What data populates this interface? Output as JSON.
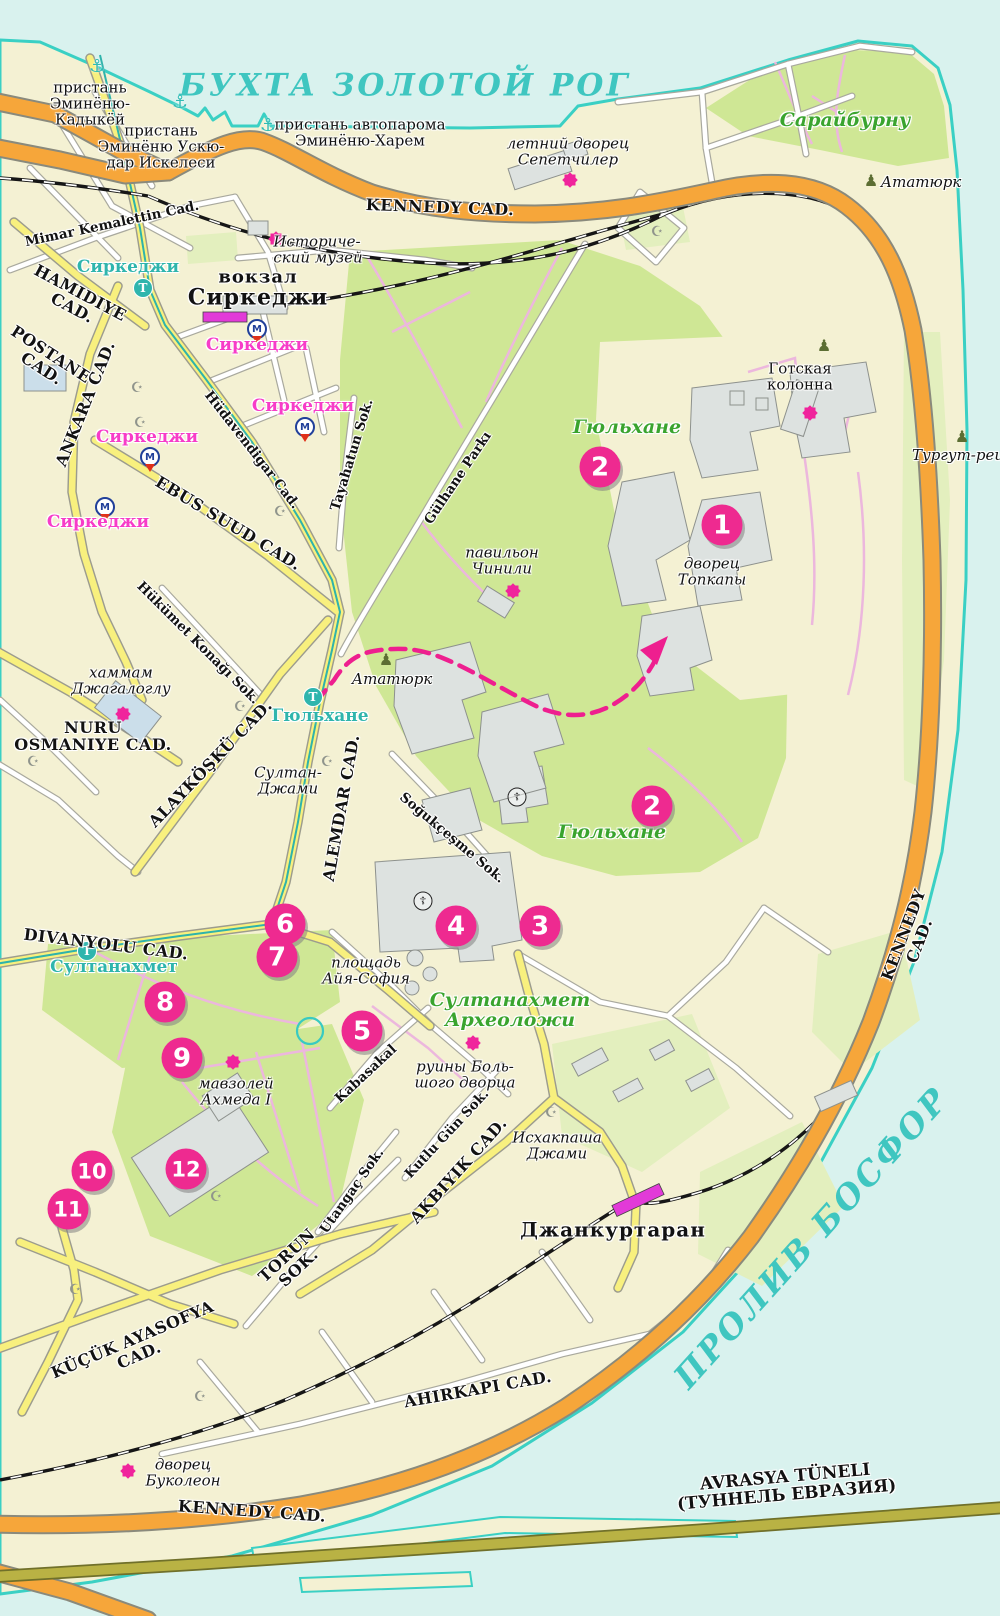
{
  "colors": {
    "water": "#d9f2ee",
    "land": "#f4f1d3",
    "coast": "#3ad0c4",
    "park": "#cfe795",
    "park_pale": "#e3efbe",
    "park_path": "#ecb7dd",
    "road_major": "#f6a63a",
    "road_secondary": "#f8f07e",
    "tunnel_road": "#b9b244",
    "route": "#ee1f8f",
    "marker": "#ee2a90",
    "star": "#f0249c",
    "station_rect": "#e23ad8",
    "sea_label": "#3fc6c0",
    "green_label": "#3aa42e",
    "tram_label": "#2fb5ad",
    "metro_label": "#f73cc8"
  },
  "glyphs": {
    "anchor": "⚓",
    "mosque": "☪",
    "church": "☦",
    "monument": "♟",
    "tram": "T",
    "metro": "M"
  },
  "labels": [
    {
      "name": "label-bay-golden-horn",
      "lines": [
        "БУХТА ЗОЛОТОЙ РОГ"
      ],
      "x": 405,
      "y": 86,
      "rot": 0,
      "cls": "sea sea-top"
    },
    {
      "name": "label-bosphorus",
      "lines": [
        "ПРОЛИВ БОСФОР"
      ],
      "x": 812,
      "y": 1238,
      "rot": -48,
      "cls": "sea sea-right"
    },
    {
      "name": "label-pier-eminonu-kadikoy",
      "lines": [
        "пристань",
        "Эминёню-",
        "Кадыкёй"
      ],
      "x": 90,
      "y": 104,
      "rot": 0,
      "cls": "place"
    },
    {
      "name": "label-pier-eminonu-uskudar",
      "lines": [
        "пристань",
        "Эминёню Ускю-",
        "дар Искелеси"
      ],
      "x": 161,
      "y": 147,
      "rot": 0,
      "cls": "place"
    },
    {
      "name": "label-pier-car-ferry",
      "lines": [
        "пристань автопарома",
        "Эминёню-Харем"
      ],
      "x": 360,
      "y": 133,
      "rot": 0,
      "cls": "place"
    },
    {
      "name": "label-summer-palace",
      "lines": [
        "летний дворец",
        "Сепетчилер"
      ],
      "x": 568,
      "y": 152,
      "rot": 0,
      "cls": "place-it"
    },
    {
      "name": "label-sarayburnu",
      "lines": [
        "Сарайбурну"
      ],
      "x": 845,
      "y": 121,
      "rot": 0,
      "cls": "green"
    },
    {
      "name": "label-ataturk-ne",
      "lines": [
        "Ататюрк"
      ],
      "x": 921,
      "y": 183,
      "rot": 0,
      "cls": "place-it"
    },
    {
      "name": "label-kennedy-top",
      "lines": [
        "KENNEDY CAD."
      ],
      "x": 440,
      "y": 208,
      "rot": 2,
      "cls": "road-lg"
    },
    {
      "name": "label-mimar-kemalettin",
      "lines": [
        "Mimar Kemalettin Cad."
      ],
      "x": 112,
      "y": 224,
      "rot": -12,
      "cls": "road"
    },
    {
      "name": "label-sirkeci-tram",
      "lines": [
        "Сиркеджи"
      ],
      "x": 128,
      "y": 268,
      "rot": 0,
      "cls": "tram-stop"
    },
    {
      "name": "label-station-vokzal",
      "lines": [
        "вокзал"
      ],
      "x": 258,
      "y": 278,
      "rot": 0,
      "cls": "place-lg"
    },
    {
      "name": "label-station-sirkeci",
      "lines": [
        "Сиркеджи"
      ],
      "x": 258,
      "y": 298,
      "rot": 0,
      "cls": "place-xl"
    },
    {
      "name": "label-history-museum",
      "lines": [
        "Историче-",
        "ский музей"
      ],
      "x": 318,
      "y": 250,
      "rot": 0,
      "cls": "place-it left"
    },
    {
      "name": "label-sirkeci-m1",
      "lines": [
        "Сиркеджи"
      ],
      "x": 257,
      "y": 346,
      "rot": 0,
      "cls": "metro-stop"
    },
    {
      "name": "label-hamidiye",
      "lines": [
        "HAMIDIYE",
        "CAD."
      ],
      "x": 76,
      "y": 301,
      "rot": 28,
      "cls": "road-lg"
    },
    {
      "name": "label-postane",
      "lines": [
        "POSTANE",
        "CAD."
      ],
      "x": 46,
      "y": 362,
      "rot": 33,
      "cls": "road-lg"
    },
    {
      "name": "label-ankara",
      "lines": [
        "ANKARA CAD."
      ],
      "x": 86,
      "y": 404,
      "rot": -68,
      "cls": "road-lg"
    },
    {
      "name": "label-sirkeci-m2",
      "lines": [
        "Сиркеджи"
      ],
      "x": 303,
      "y": 407,
      "rot": 0,
      "cls": "metro-stop"
    },
    {
      "name": "label-sirkeci-m3",
      "lines": [
        "Сиркеджи"
      ],
      "x": 147,
      "y": 438,
      "rot": 0,
      "cls": "metro-stop"
    },
    {
      "name": "label-sirkeci-m4",
      "lines": [
        "Сиркеджи"
      ],
      "x": 98,
      "y": 523,
      "rot": 0,
      "cls": "metro-stop"
    },
    {
      "name": "label-hudavendigar",
      "lines": [
        "Hüdavendigar Cad."
      ],
      "x": 252,
      "y": 450,
      "rot": 52,
      "cls": "road"
    },
    {
      "name": "label-tayahatun",
      "lines": [
        "Tayahatun Sok."
      ],
      "x": 352,
      "y": 455,
      "rot": -73,
      "cls": "road"
    },
    {
      "name": "label-ebussuud",
      "lines": [
        "EBUS SUUD CAD."
      ],
      "x": 228,
      "y": 524,
      "rot": 31,
      "cls": "road-lg"
    },
    {
      "name": "label-gulhane-parki",
      "lines": [
        "Gülhane Parkı"
      ],
      "x": 458,
      "y": 478,
      "rot": -56,
      "cls": "road"
    },
    {
      "name": "label-gulhane-green-1",
      "lines": [
        "Гюльхане"
      ],
      "x": 627,
      "y": 428,
      "rot": 0,
      "cls": "green"
    },
    {
      "name": "label-gulhane-green-2",
      "lines": [
        "Гюльхане"
      ],
      "x": 612,
      "y": 833,
      "rot": 0,
      "cls": "green"
    },
    {
      "name": "label-gothic-column",
      "lines": [
        "Готская",
        "колонна"
      ],
      "x": 800,
      "y": 377,
      "rot": 0,
      "cls": "place"
    },
    {
      "name": "label-turgut",
      "lines": [
        "Тургут-реи"
      ],
      "x": 958,
      "y": 456,
      "rot": 0,
      "cls": "place-it"
    },
    {
      "name": "label-cinili",
      "lines": [
        "павильон",
        "Чинили"
      ],
      "x": 502,
      "y": 561,
      "rot": 0,
      "cls": "place-it"
    },
    {
      "name": "label-topkapi",
      "lines": [
        "дворец",
        "Топкапы"
      ],
      "x": 712,
      "y": 572,
      "rot": 0,
      "cls": "place-it"
    },
    {
      "name": "label-hamam",
      "lines": [
        "хаммам",
        "Джагалоглу"
      ],
      "x": 121,
      "y": 681,
      "rot": 0,
      "cls": "place-it"
    },
    {
      "name": "label-nuruosmaniye",
      "lines": [
        "NURU",
        "OSMANIYE CAD."
      ],
      "x": 93,
      "y": 737,
      "rot": 0,
      "cls": "road-lg"
    },
    {
      "name": "label-hukumet-konagi",
      "lines": [
        "Hükümet Konağı Sok."
      ],
      "x": 198,
      "y": 643,
      "rot": 45,
      "cls": "road"
    },
    {
      "name": "label-gulhane-tram",
      "lines": [
        "Гюльхане"
      ],
      "x": 320,
      "y": 717,
      "rot": 0,
      "cls": "tram-stop"
    },
    {
      "name": "label-ataturk-center",
      "lines": [
        "Ататюрк"
      ],
      "x": 392,
      "y": 680,
      "rot": 0,
      "cls": "place-it"
    },
    {
      "name": "label-sultan-cami",
      "lines": [
        "Султан-",
        "Джами"
      ],
      "x": 288,
      "y": 781,
      "rot": 0,
      "cls": "place-it"
    },
    {
      "name": "label-alemdar",
      "lines": [
        "ALEMDAR CAD."
      ],
      "x": 342,
      "y": 808,
      "rot": -80,
      "cls": "road-lg"
    },
    {
      "name": "label-alaykosku",
      "lines": [
        "ALAYKÖŞKÜ CAD."
      ],
      "x": 211,
      "y": 764,
      "rot": -46,
      "cls": "road-lg"
    },
    {
      "name": "label-sogukcesme",
      "lines": [
        "Soğukçeşme Sok."
      ],
      "x": 452,
      "y": 838,
      "rot": 40,
      "cls": "road"
    },
    {
      "name": "label-divanyolu",
      "lines": [
        "DIVANYOLU CAD."
      ],
      "x": 106,
      "y": 945,
      "rot": 7,
      "cls": "road-lg"
    },
    {
      "name": "label-sultanahmet-tram",
      "lines": [
        "Султанахмет"
      ],
      "x": 114,
      "y": 968,
      "rot": 0,
      "cls": "tram-stop"
    },
    {
      "name": "label-ayasofya-square",
      "lines": [
        "площадь",
        "Айя-София"
      ],
      "x": 366,
      "y": 971,
      "rot": 0,
      "cls": "place-it"
    },
    {
      "name": "label-sultanahmet-arch",
      "lines": [
        "Султанахмет",
        "Археоложи"
      ],
      "x": 510,
      "y": 1011,
      "rot": 0,
      "cls": "green"
    },
    {
      "name": "label-palace-ruins",
      "lines": [
        "руины Боль-",
        "шого дворца"
      ],
      "x": 465,
      "y": 1075,
      "rot": 0,
      "cls": "place-it"
    },
    {
      "name": "label-mausoleum",
      "lines": [
        "мавзолей",
        "Ахмеда I"
      ],
      "x": 236,
      "y": 1092,
      "rot": 0,
      "cls": "place-it"
    },
    {
      "name": "label-kabasakal",
      "lines": [
        "Kabasakal"
      ],
      "x": 366,
      "y": 1074,
      "rot": -43,
      "cls": "road"
    },
    {
      "name": "label-kutlu-gun",
      "lines": [
        "Kutlu Gün Sok."
      ],
      "x": 447,
      "y": 1134,
      "rot": -47,
      "cls": "road"
    },
    {
      "name": "label-utangac",
      "lines": [
        "Utangaç Sok."
      ],
      "x": 352,
      "y": 1191,
      "rot": -55,
      "cls": "road"
    },
    {
      "name": "label-akbiyik",
      "lines": [
        "AKBIYIK CAD."
      ],
      "x": 459,
      "y": 1171,
      "rot": -48,
      "cls": "road-lg"
    },
    {
      "name": "label-ishakpasha",
      "lines": [
        "Исхакпаша",
        "Джами"
      ],
      "x": 557,
      "y": 1146,
      "rot": 0,
      "cls": "place-it"
    },
    {
      "name": "label-cankurtaran",
      "lines": [
        "Джанкуртаран"
      ],
      "x": 613,
      "y": 1230,
      "rot": 0,
      "cls": "station-name"
    },
    {
      "name": "label-torun",
      "lines": [
        "TORUN",
        "SOK."
      ],
      "x": 293,
      "y": 1262,
      "rot": -43,
      "cls": "road-lg"
    },
    {
      "name": "label-kucuk-ayasofya",
      "lines": [
        "KÜÇÜK AYASOFYA",
        "CAD."
      ],
      "x": 136,
      "y": 1348,
      "rot": -23,
      "cls": "road-lg"
    },
    {
      "name": "label-ahirkapi",
      "lines": [
        "AHIRKAPI CAD."
      ],
      "x": 478,
      "y": 1390,
      "rot": -10,
      "cls": "road-lg"
    },
    {
      "name": "label-bucoleon",
      "lines": [
        "дворец",
        "Буколеон"
      ],
      "x": 183,
      "y": 1473,
      "rot": 0,
      "cls": "place-it"
    },
    {
      "name": "label-kennedy-bottom",
      "lines": [
        "KENNEDY CAD."
      ],
      "x": 252,
      "y": 1512,
      "rot": 4,
      "cls": "road-lg"
    },
    {
      "name": "label-avrasya",
      "lines": [
        "AVRASYA TÜNELI",
        "(ТУННЕЛЬ ЕВРАЗИЯ)"
      ],
      "x": 786,
      "y": 1487,
      "rot": -5,
      "cls": "tunnel"
    },
    {
      "name": "label-kennedy-right",
      "lines": [
        "KENNEDY",
        "CAD."
      ],
      "x": 912,
      "y": 938,
      "rot": -69,
      "cls": "road-lg"
    }
  ],
  "markers": [
    {
      "n": "1",
      "x": 722,
      "y": 525
    },
    {
      "n": "2",
      "x": 600,
      "y": 467
    },
    {
      "n": "2",
      "x": 652,
      "y": 806
    },
    {
      "n": "3",
      "x": 540,
      "y": 926
    },
    {
      "n": "4",
      "x": 456,
      "y": 926
    },
    {
      "n": "5",
      "x": 362,
      "y": 1031
    },
    {
      "n": "6",
      "x": 285,
      "y": 924
    },
    {
      "n": "7",
      "x": 277,
      "y": 957
    },
    {
      "n": "8",
      "x": 165,
      "y": 1002
    },
    {
      "n": "9",
      "x": 182,
      "y": 1058
    },
    {
      "n": "10",
      "x": 92,
      "y": 1171
    },
    {
      "n": "11",
      "x": 68,
      "y": 1209
    },
    {
      "n": "12",
      "x": 186,
      "y": 1169
    }
  ],
  "icons": [
    {
      "t": "anchor",
      "x": 97,
      "y": 67
    },
    {
      "t": "anchor",
      "x": 180,
      "y": 103
    },
    {
      "t": "anchor",
      "x": 268,
      "y": 126
    },
    {
      "t": "tram",
      "x": 143,
      "y": 288
    },
    {
      "t": "tram",
      "x": 313,
      "y": 697
    },
    {
      "t": "tram",
      "x": 87,
      "y": 951
    },
    {
      "t": "metro",
      "x": 257,
      "y": 329
    },
    {
      "t": "metro",
      "x": 305,
      "y": 427
    },
    {
      "t": "metro",
      "x": 150,
      "y": 457
    },
    {
      "t": "metro",
      "x": 105,
      "y": 507
    },
    {
      "t": "mosque",
      "x": 137,
      "y": 388
    },
    {
      "t": "mosque",
      "x": 140,
      "y": 423
    },
    {
      "t": "mosque",
      "x": 280,
      "y": 512
    },
    {
      "t": "mosque",
      "x": 240,
      "y": 707
    },
    {
      "t": "mosque",
      "x": 33,
      "y": 762
    },
    {
      "t": "mosque",
      "x": 327,
      "y": 762
    },
    {
      "t": "mosque",
      "x": 216,
      "y": 1197
    },
    {
      "t": "mosque",
      "x": 551,
      "y": 1113
    },
    {
      "t": "mosque",
      "x": 75,
      "y": 1290
    },
    {
      "t": "mosque",
      "x": 200,
      "y": 1397
    },
    {
      "t": "mosque",
      "x": 657,
      "y": 232
    },
    {
      "t": "church",
      "x": 423,
      "y": 901
    },
    {
      "t": "church",
      "x": 517,
      "y": 797
    },
    {
      "t": "monument",
      "x": 871,
      "y": 181
    },
    {
      "t": "monument",
      "x": 824,
      "y": 346
    },
    {
      "t": "monument",
      "x": 962,
      "y": 437
    },
    {
      "t": "monument",
      "x": 386,
      "y": 660
    },
    {
      "t": "star",
      "x": 276,
      "y": 239
    },
    {
      "t": "star",
      "x": 570,
      "y": 180
    },
    {
      "t": "star",
      "x": 810,
      "y": 413
    },
    {
      "t": "star",
      "x": 513,
      "y": 591
    },
    {
      "t": "star",
      "x": 123,
      "y": 714
    },
    {
      "t": "star",
      "x": 473,
      "y": 1043
    },
    {
      "t": "star",
      "x": 233,
      "y": 1062
    },
    {
      "t": "star",
      "x": 128,
      "y": 1471
    }
  ]
}
